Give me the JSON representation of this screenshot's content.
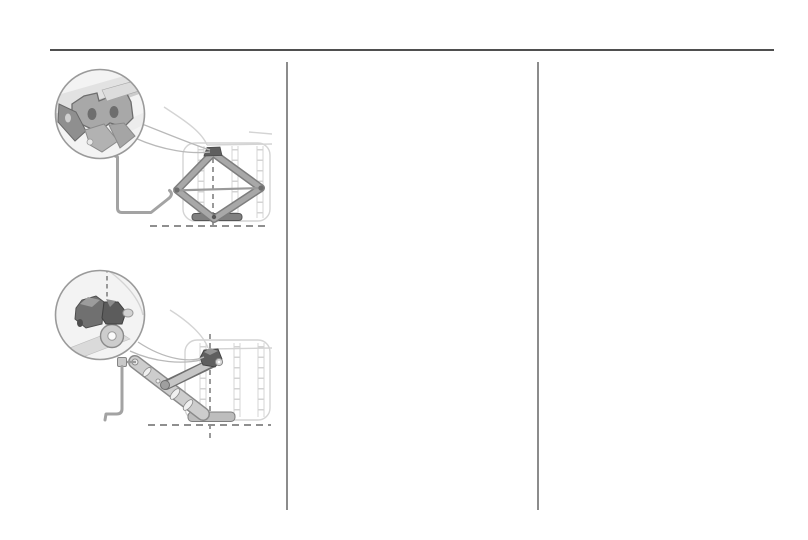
{
  "window": {
    "width_px": 808,
    "height_px": 540
  },
  "palette": {
    "page-bg": "#ffffff",
    "rule": "#4f4f4f",
    "divider": "#8c8c8c",
    "ln-faint": "#d4d4d4",
    "ln-light": "#b9b9b9",
    "ln-mid": "#9a9a9a",
    "dash": "#8f8f8f",
    "rod": "#a3a3a3",
    "inset-bg": "#f3f3f3",
    "metal-mid": "#a8a8a8",
    "metal-dark": "#6e6e6e",
    "metal-darker": "#5f5f5f"
  },
  "layout": {
    "columns": 3,
    "column_dividers": 2,
    "header_rule": true,
    "visible_text": ""
  },
  "figures": [
    {
      "id": "fig-scissor-jack",
      "name": "scissor-jack-at-jacking-point-with-magnifier-inset"
    },
    {
      "id": "fig-crank-jack",
      "name": "crank-handle-jack-at-jacking-point-with-magnifier-inset"
    }
  ]
}
